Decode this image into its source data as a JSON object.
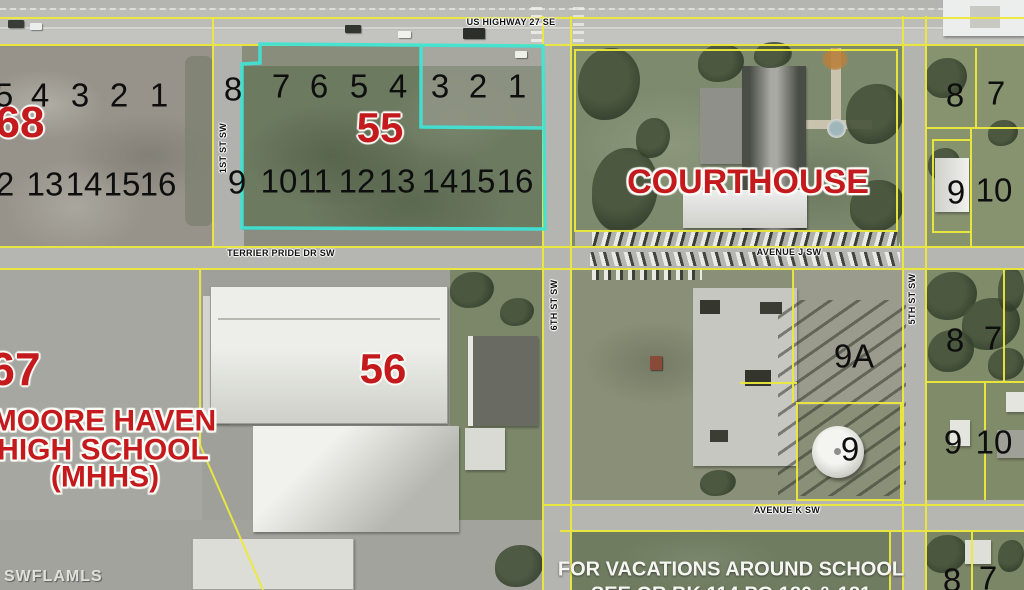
{
  "streets": {
    "us_highway_27": "US HIGHWAY 27 SE",
    "terrier_pride": "TERRIER PRIDE DR SW",
    "avenue_j": "AVENUE J SW",
    "avenue_k": "AVENUE K SW",
    "first_st": "1ST ST SW",
    "sixth_st": "6TH ST SW",
    "fifth_st": "5TH ST SW"
  },
  "landmarks": {
    "courthouse": "COURTHOUSE",
    "school_line1": "MOORE HAVEN",
    "school_line2": "HIGH SCHOOL",
    "school_line3": "(MHHS)"
  },
  "note": {
    "line1": "FOR VACATIONS AROUND SCHOOL",
    "line2": "SEE OR BK 114 PG 180 & 181"
  },
  "watermark": "SWFLAMLS",
  "parcel_labels": [
    {
      "text": "68",
      "x": 20,
      "y": 123,
      "size": 44
    },
    {
      "text": "55",
      "x": 380,
      "y": 128,
      "size": 42
    },
    {
      "text": "67",
      "x": 15,
      "y": 369,
      "size": 46
    },
    {
      "text": "56",
      "x": 383,
      "y": 369,
      "size": 42
    }
  ],
  "lot_numbers": [
    {
      "t": "8",
      "x": 233,
      "y": 89
    },
    {
      "t": "7",
      "x": 281,
      "y": 86
    },
    {
      "t": "6",
      "x": 319,
      "y": 86
    },
    {
      "t": "5",
      "x": 359,
      "y": 86
    },
    {
      "t": "4",
      "x": 398,
      "y": 86
    },
    {
      "t": "3",
      "x": 440,
      "y": 86
    },
    {
      "t": "2",
      "x": 478,
      "y": 86
    },
    {
      "t": "1",
      "x": 517,
      "y": 86
    },
    {
      "t": "9",
      "x": 237,
      "y": 182
    },
    {
      "t": "10",
      "x": 279,
      "y": 181
    },
    {
      "t": "11",
      "x": 315,
      "y": 181
    },
    {
      "t": "12",
      "x": 357,
      "y": 181
    },
    {
      "t": "13",
      "x": 397,
      "y": 181
    },
    {
      "t": "14",
      "x": 440,
      "y": 181
    },
    {
      "t": "15",
      "x": 477,
      "y": 181
    },
    {
      "t": "16",
      "x": 515,
      "y": 181
    },
    {
      "t": "5",
      "x": 4,
      "y": 95
    },
    {
      "t": "4",
      "x": 40,
      "y": 95
    },
    {
      "t": "3",
      "x": 80,
      "y": 95
    },
    {
      "t": "2",
      "x": 119,
      "y": 95
    },
    {
      "t": "1",
      "x": 159,
      "y": 95
    },
    {
      "t": "2",
      "x": 5,
      "y": 184
    },
    {
      "t": "13",
      "x": 45,
      "y": 184
    },
    {
      "t": "14",
      "x": 84,
      "y": 184
    },
    {
      "t": "15",
      "x": 122,
      "y": 184
    },
    {
      "t": "16",
      "x": 158,
      "y": 184
    },
    {
      "t": "8",
      "x": 955,
      "y": 95
    },
    {
      "t": "7",
      "x": 996,
      "y": 93
    },
    {
      "t": "9",
      "x": 956,
      "y": 192
    },
    {
      "t": "10",
      "x": 994,
      "y": 190
    },
    {
      "t": "8",
      "x": 955,
      "y": 340
    },
    {
      "t": "7",
      "x": 993,
      "y": 338
    },
    {
      "t": "9",
      "x": 953,
      "y": 442
    },
    {
      "t": "10",
      "x": 994,
      "y": 442
    },
    {
      "t": "9A",
      "x": 854,
      "y": 356
    },
    {
      "t": "9",
      "x": 850,
      "y": 449
    },
    {
      "t": "8",
      "x": 952,
      "y": 580
    },
    {
      "t": "7",
      "x": 988,
      "y": 578
    }
  ],
  "colors": {
    "parcel_line": "#ece93c",
    "highlight": "#3fe3d4",
    "label_red": "#c41a1e"
  }
}
